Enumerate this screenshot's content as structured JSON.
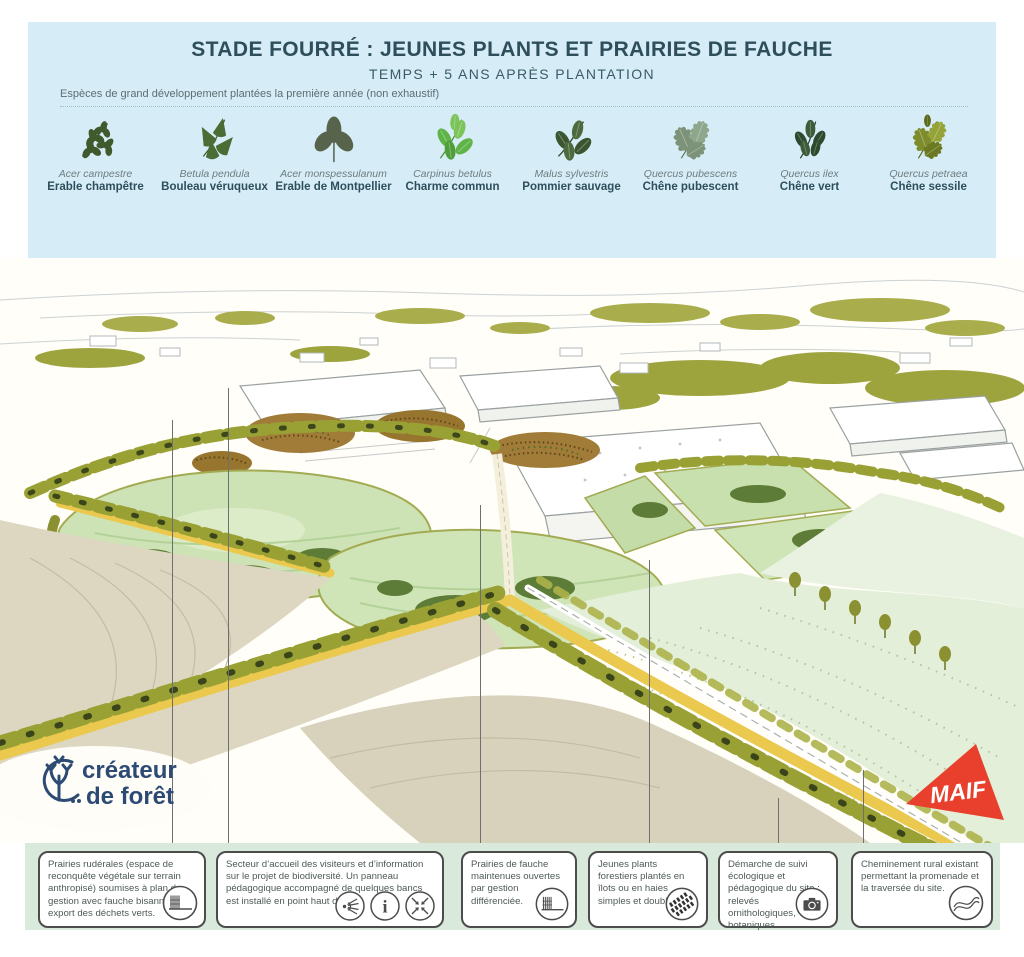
{
  "header": {
    "title": "STADE FOURRÉ : JEUNES PLANTS ET PRAIRIES DE FAUCHE",
    "subtitle": "TEMPS + 5 ANS APRÈS PLANTATION",
    "legend_caption": "Espèces de grand développement plantées la première année (non exhaustif)"
  },
  "species": [
    {
      "latin": "Acer campestre",
      "french": "Erable champêtre",
      "icon": "field-maple-leaf-icon"
    },
    {
      "latin": "Betula pendula",
      "french": "Bouleau véruqueux",
      "icon": "birch-leaf-icon"
    },
    {
      "latin": "Acer monspessulanum",
      "french": "Erable de Montpellier",
      "icon": "montpellier-maple-leaf-icon"
    },
    {
      "latin": "Carpinus betulus",
      "french": "Charme commun",
      "icon": "hornbeam-leaf-icon"
    },
    {
      "latin": "Malus sylvestris",
      "french": "Pommier sauvage",
      "icon": "crab-apple-leaf-icon"
    },
    {
      "latin": "Quercus pubescens",
      "french": "Chêne pubescent",
      "icon": "downy-oak-leaf-icon"
    },
    {
      "latin": "Quercus ilex",
      "french": "Chêne vert",
      "icon": "holm-oak-leaf-icon"
    },
    {
      "latin": "Quercus petraea",
      "french": "Chêne sessile",
      "icon": "sessile-oak-leaf-icon"
    }
  ],
  "annotations": [
    {
      "text": "Prairies rudérales (espace de reconquête végétale sur terrain anthropisé) soumises à plan de gestion avec fauche bisannuelle et export des déchets verts.",
      "icons": [
        "mowing-icon"
      ]
    },
    {
      "text": "Secteur d’accueil des visiteurs et d’information sur le projet de biodiversité. Un panneau pédagogique accompagné de quelques bancs est installé en point haut du site.",
      "icons": [
        "viewpoint-icon",
        "info-icon",
        "meeting-point-icon"
      ]
    },
    {
      "text": "Prairies de fauche maintenues ouvertes par gestion différenciée.",
      "icons": [
        "mowing-icon"
      ]
    },
    {
      "text": "Jeunes plants forestiers plantés en îlots ou en haies simples et doubles.",
      "icons": [
        "hedgerow-stripes-icon"
      ]
    },
    {
      "text": "Démarche de suivi écologique et pédagogique du site : relevés ornithologiques, botaniques.",
      "icons": [
        "camera-icon"
      ]
    },
    {
      "text": "Cheminement rural existant permettant la promenade et la traversée du site.",
      "icons": [
        "winding-path-icon"
      ]
    }
  ],
  "logos": {
    "creator": {
      "line1": "créateur",
      "line2": "de forêt"
    },
    "maif": {
      "label": "MAIF"
    }
  },
  "colors": {
    "header_blue": "#d6ecf7",
    "title_dark": "#2e4e5c",
    "band_green": "#d9e9dc",
    "maif_red": "#e8402c",
    "creator_navy": "#2d4a75",
    "olive": "#9aa134",
    "meadow_green": "#cfe5b8",
    "field_beige": "#ddd7c2",
    "road_yellow": "#eac94e"
  }
}
